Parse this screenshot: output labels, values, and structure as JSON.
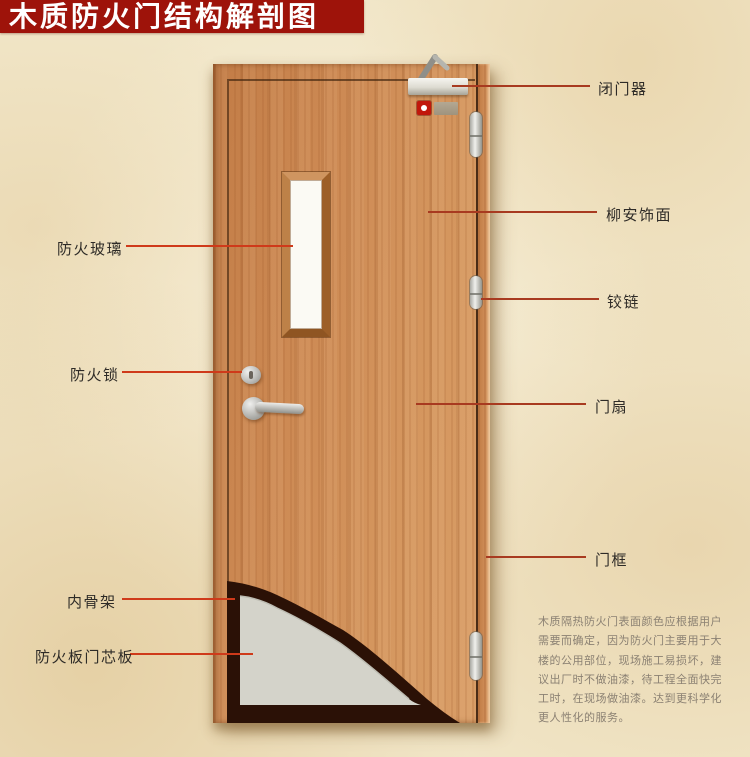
{
  "title": "木质防火门结构解剖图",
  "colors": {
    "banner_red": "#9e130a",
    "leader_line_right": "#a83a20",
    "leader_line_left": "#cf3a1a",
    "door_wood": "#cd8a54",
    "core_gray": "#d4d3ca",
    "skeleton_dark": "#2b1106"
  },
  "labels": {
    "left": [
      {
        "text": "防火玻璃"
      },
      {
        "text": "防火锁"
      },
      {
        "text": "内骨架"
      },
      {
        "text": "防火板门芯板"
      }
    ],
    "right": [
      {
        "text": "闭门器"
      },
      {
        "text": "柳安饰面"
      },
      {
        "text": "铰链"
      },
      {
        "text": "门扇"
      },
      {
        "text": "门框"
      }
    ]
  },
  "description": {
    "text": "木质隔热防火门表面颜色应根据用户\n需要而确定，因为防火门主要用于大\n楼的公用部位，现场施工易损坏，建\n议出厂时不做油漆，待工程全面快完\n工时，在现场做油漆。达到更科学化\n更人性化的服务。"
  }
}
